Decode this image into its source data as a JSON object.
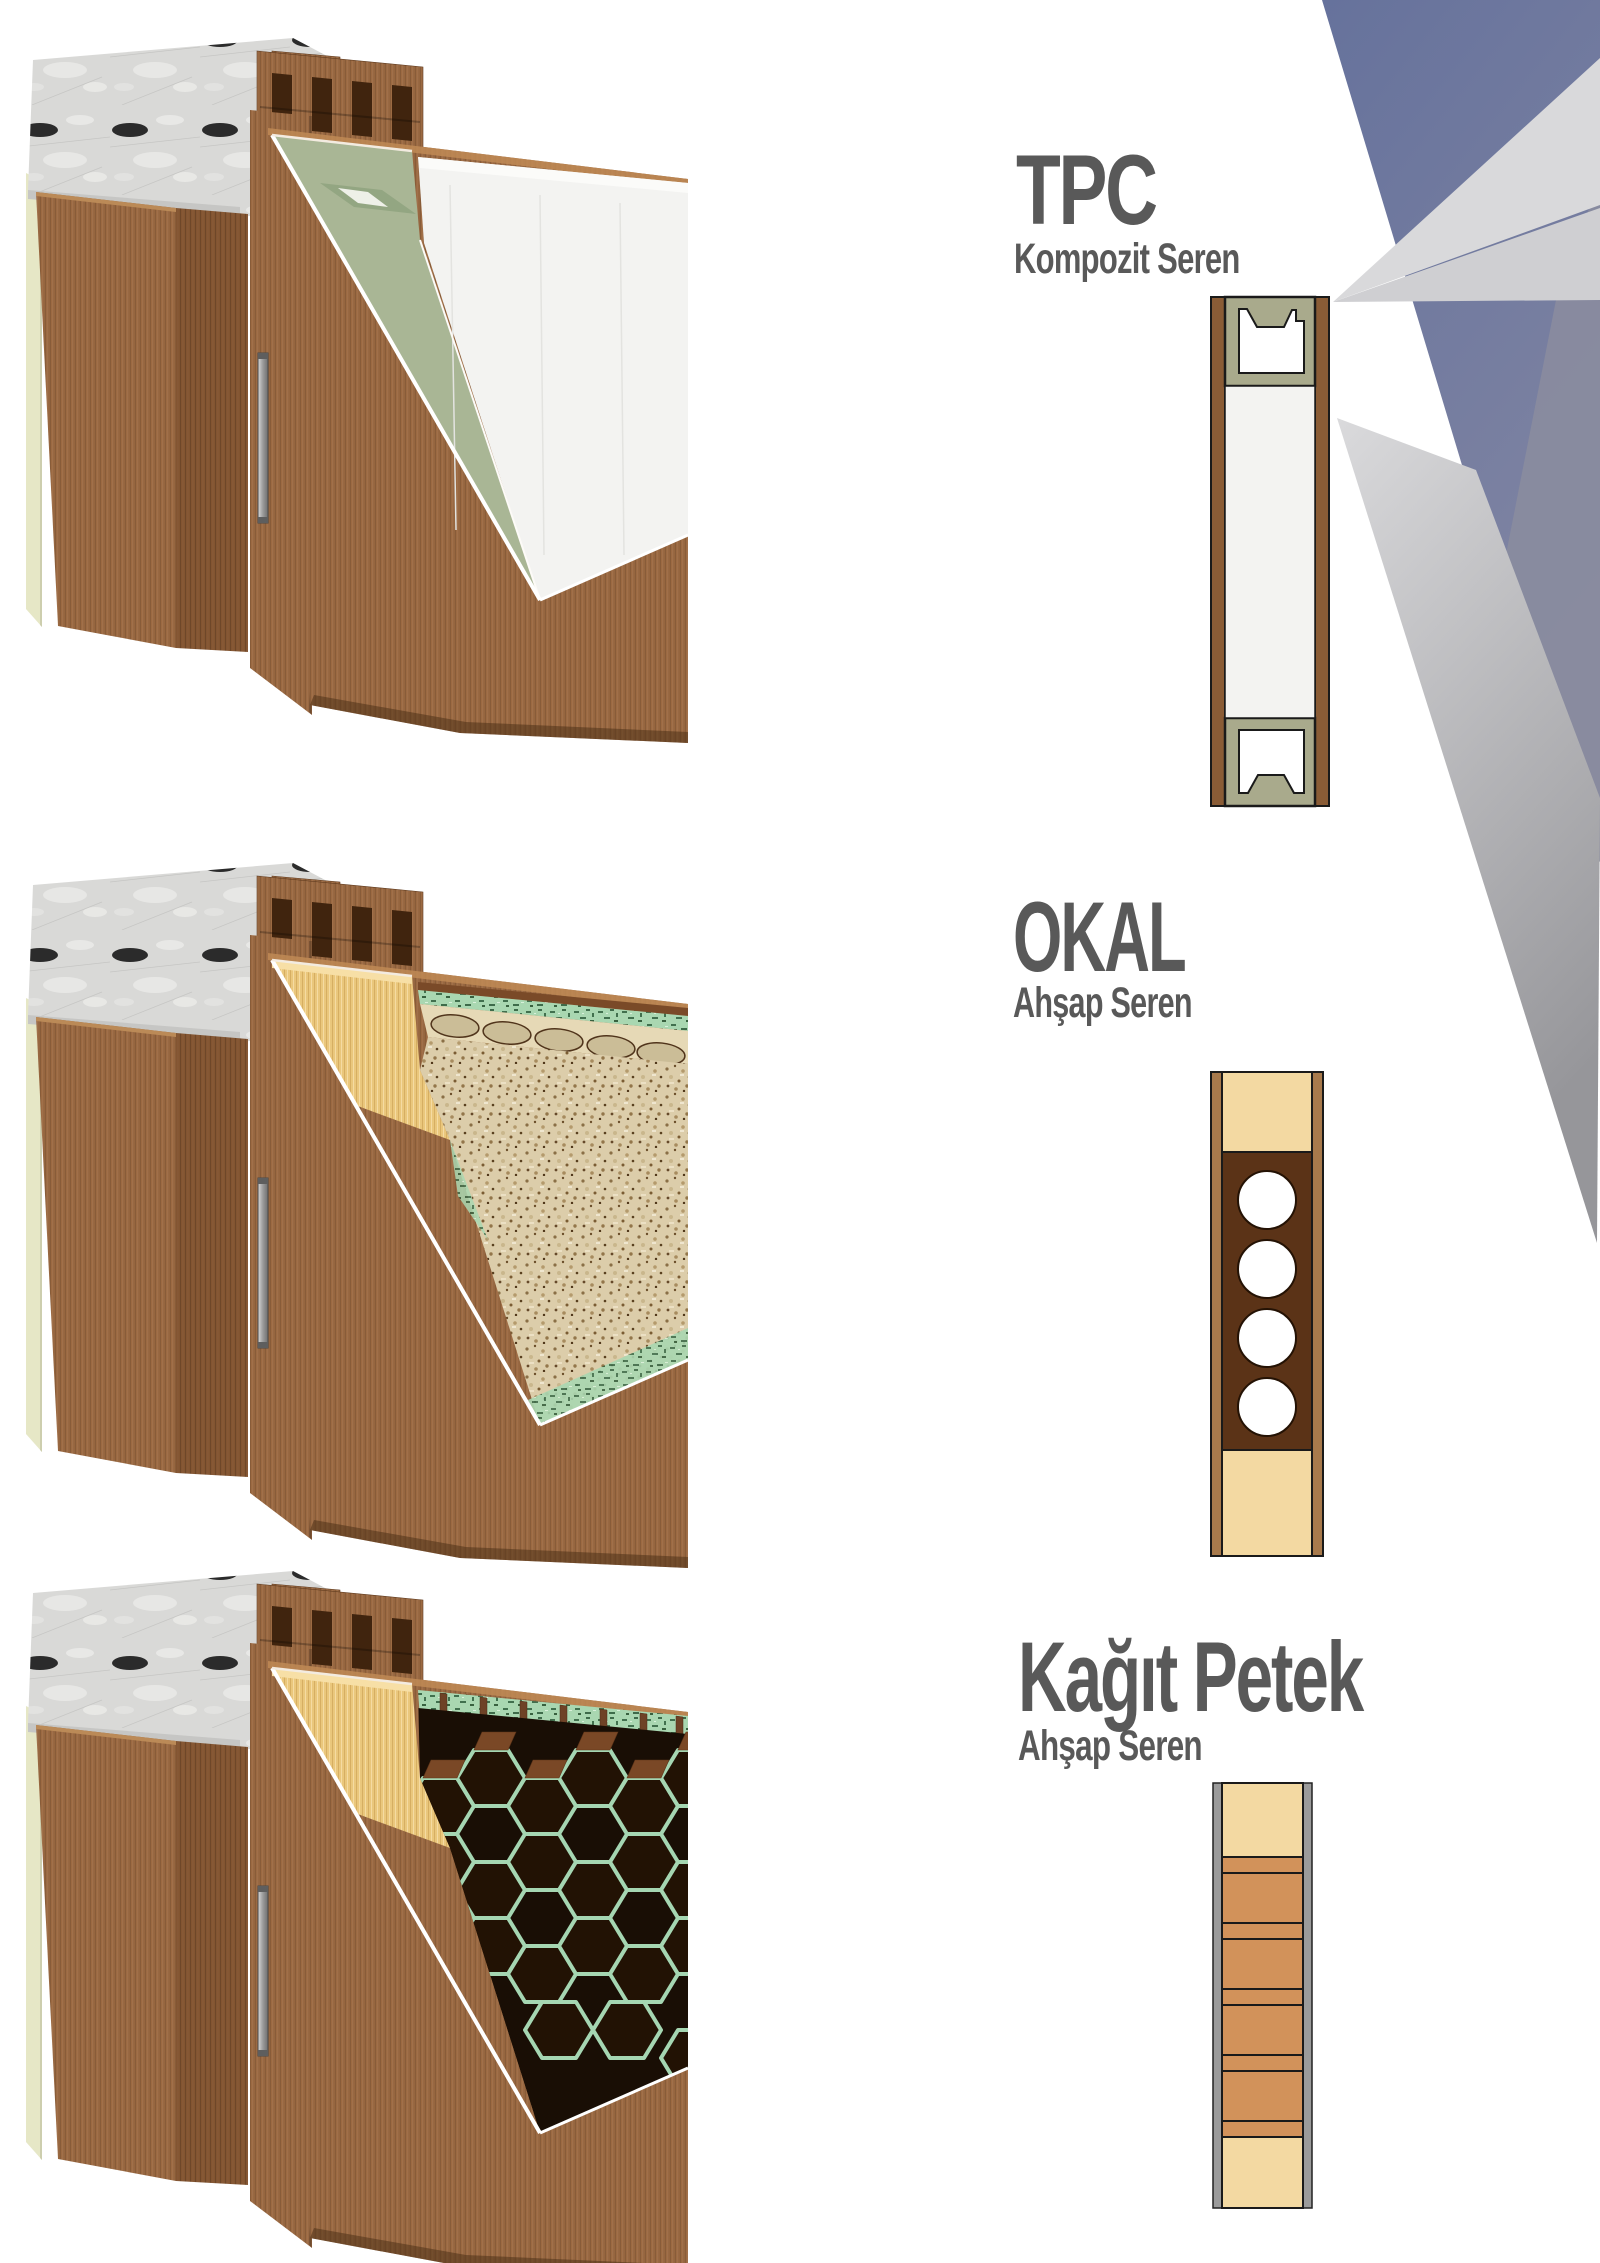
{
  "page": {
    "width": 1600,
    "height": 2263,
    "background": "#ffffff",
    "text_color": "#595959"
  },
  "sections": [
    {
      "id": "tpc",
      "title": "TPC",
      "subtitle": "Kompozit Seren",
      "render": "door-corner-cutaway-with-composite-stile-and-white-core",
      "colors": {
        "door_skin": "#9c6a42",
        "stile": "#a9aa8c",
        "core": "#f3f3f1",
        "marble_top": "#d9d9d7",
        "wall_strip": "#e6e7c6",
        "hinge": "#b5b5b5"
      },
      "schematic": {
        "style": "composite-stile-profile",
        "skin": "#8a5c36",
        "stile": "#a9aa8c",
        "core": "#f3f3f1",
        "profile_cutout": "#ffffff"
      }
    },
    {
      "id": "okal",
      "title": "OKAL",
      "subtitle": "Ahşap Seren",
      "render": "door-corner-cutaway-with-wood-stile-and-tubular-chipboard-core",
      "colors": {
        "door_skin": "#9c6a42",
        "stile": "#eac77c",
        "core": "#dccdaa",
        "glue_edge": "#a9d7b1"
      },
      "schematic": {
        "style": "tubular-chipboard",
        "skin": "#a87a4c",
        "stile": "#f3d9a2",
        "core": "#5b3317",
        "tube_holes": 4,
        "hole_color": "#ffffff"
      }
    },
    {
      "id": "kagit-petek",
      "title": "Kağıt Petek",
      "subtitle": "Ahşap Seren",
      "render": "door-corner-cutaway-with-wood-stile-and-paper-honeycomb-core",
      "colors": {
        "door_skin": "#9c6a42",
        "stile": "#eac77c",
        "honeycomb_wall": "#7a4a28",
        "honeycomb_glue": "#a5d6b2",
        "cavity": "#1a0f06"
      },
      "schematic": {
        "style": "paper-honeycomb",
        "skin": "#9b9b9b",
        "stile": "#f3d9a2",
        "bands": "#d2925a",
        "thin_bands": 5,
        "thick_bands": 4
      }
    }
  ],
  "decoration": {
    "name": "corner-fan-graphic",
    "colors": [
      "#66729c",
      "#8a8c9e",
      "#d9d9db",
      "#e4e4e6",
      "#96969a"
    ]
  }
}
